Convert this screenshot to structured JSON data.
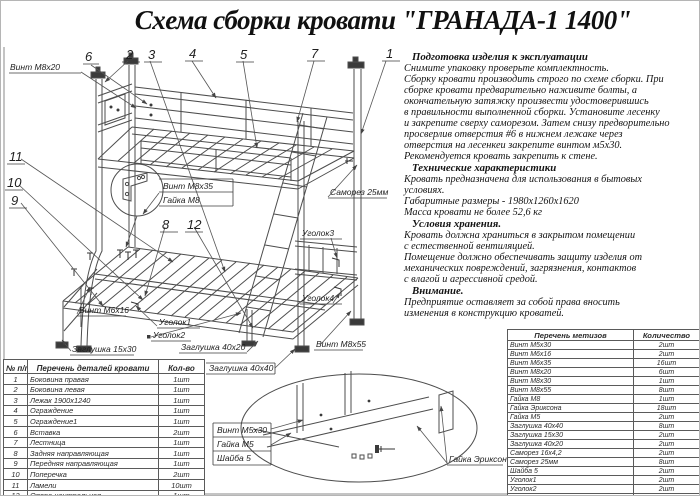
{
  "title": "Схема сборки кровати \"ГРАНАДА-1 1400\"",
  "instructions": {
    "s1_heading": "Подготовка изделия к эксплуатации",
    "s1_body": "Снимите упаковку проверьте комплектность.\nСборку кровати производить строго по схеме сборки. При\nсборке кровати  предварительно наживите  болты, а\nокончательную затяжку произвести удостоверившись\nв правильности выполненной сборки. Установите лесенку\nи закрепите сверху саморезом. Затем снизу предворительно\nпросверлив отверстия #6 в нижнем лежаке через\nотверстия на лесенкеи закрепите винтом м5х30.\nРекомендуется кровать закрепить к стене.",
    "s2_heading": "Технические характеристики",
    "s2_body": "Кровать предназначена для использования в бытовых\nусловиях.\nГабаритные размеры - 1980х1260х1620\nМасса кровати не более 52,6 кг",
    "s3_heading": "Условия хранения.",
    "s3_body": "Кровать должна храниться в закрытом помещении\nс естественной вентиляцией.\nПомещение должно обеспечивать защиту изделия от\nмеханических повреждений, загрязнения, контактов\nс влагой и агрессивной средой.",
    "s4_heading": "Внимание.",
    "s4_body": "Предприятие оставляет за собой права вносить\nизменения в конструкцию кроватей."
  },
  "parts_table": {
    "header": [
      "№ п/п",
      "Перечень деталей кровати",
      "Кол-во"
    ],
    "rows": [
      [
        "1",
        "Боковина правая",
        "1шт"
      ],
      [
        "2",
        "Боковина левая",
        "1шт"
      ],
      [
        "3",
        "Лежак 1900х1240",
        "1шт"
      ],
      [
        "4",
        "Ограждение",
        "1шт"
      ],
      [
        "5",
        "Ограждение1",
        "1шт"
      ],
      [
        "6",
        "Вставка",
        "2шт"
      ],
      [
        "7",
        "Лестница",
        "1шт"
      ],
      [
        "8",
        "Задняя направляющая",
        "1шт"
      ],
      [
        "9",
        "Передняя направляющая",
        "1шт"
      ],
      [
        "10",
        "Поперечка",
        "2шт"
      ],
      [
        "11",
        "Ламели",
        "10шт"
      ],
      [
        "12",
        "Опора центральная",
        "1шт"
      ]
    ]
  },
  "hardware_table": {
    "header": [
      "Перечень метизов",
      "Количество"
    ],
    "rows": [
      [
        "Винт М5х30",
        "2шт"
      ],
      [
        "Винт М6х16",
        "2шт"
      ],
      [
        "Винт М6х35",
        "16шт"
      ],
      [
        "Винт М8х20",
        "6шт"
      ],
      [
        "Винт М8х30",
        "1шт"
      ],
      [
        "Винт М8х55",
        "8шт"
      ],
      [
        "Гайка М8",
        "1шт"
      ],
      [
        "Гайка Эриксона",
        "18шт"
      ],
      [
        "Гайка М5",
        "2шт"
      ],
      [
        "Заглушка 40х40",
        "8шт"
      ],
      [
        "Заглушка 15х30",
        "2шт"
      ],
      [
        "Заглушка 40х20",
        "2шт"
      ],
      [
        "Саморез 16х4,2",
        "2шт"
      ],
      [
        "Саморез 25мм",
        "8шт"
      ],
      [
        "Шайба 5",
        "2шт"
      ],
      [
        "Уголок1",
        "2шт"
      ],
      [
        "Уголок2",
        "2шт"
      ],
      [
        "Уголок3",
        "2шт"
      ],
      [
        "Уголок4",
        "2шт"
      ]
    ]
  },
  "diagram": {
    "labels": {
      "vint_m8x20": "Винт М8х20",
      "vint_m8x35": "Винт М8х35",
      "gaika_m8": "Гайка М8",
      "samorez_25mm": "Саморез 25мм",
      "ugolok3": "Уголок3",
      "ugolok4": "Уголок4",
      "vint_m8x55": "Винт М8х55",
      "vint_m6x16": "Винт М6х16",
      "zaglushka_15x30": "Заглушка 15х30",
      "ugolok1": "Уголок1",
      "ugolok2": "Уголок2",
      "zaglushka_40x20": "Заглушка 40х20",
      "zaglushka_40x40": "Заглушка 40х40",
      "vint_m5x30": "Винт М5х30",
      "gaika_m5": "Гайка М5",
      "shaiba_5": "Шайба 5",
      "gaika_eriksona": "Гайка Эриксона"
    },
    "callouts": {
      "c1": "1",
      "c2": "2",
      "c3": "3",
      "c4": "4",
      "c5": "5",
      "c6": "6",
      "c7": "7",
      "c8": "8",
      "c9": "9",
      "c10": "10",
      "c11": "11",
      "c12": "12"
    }
  }
}
